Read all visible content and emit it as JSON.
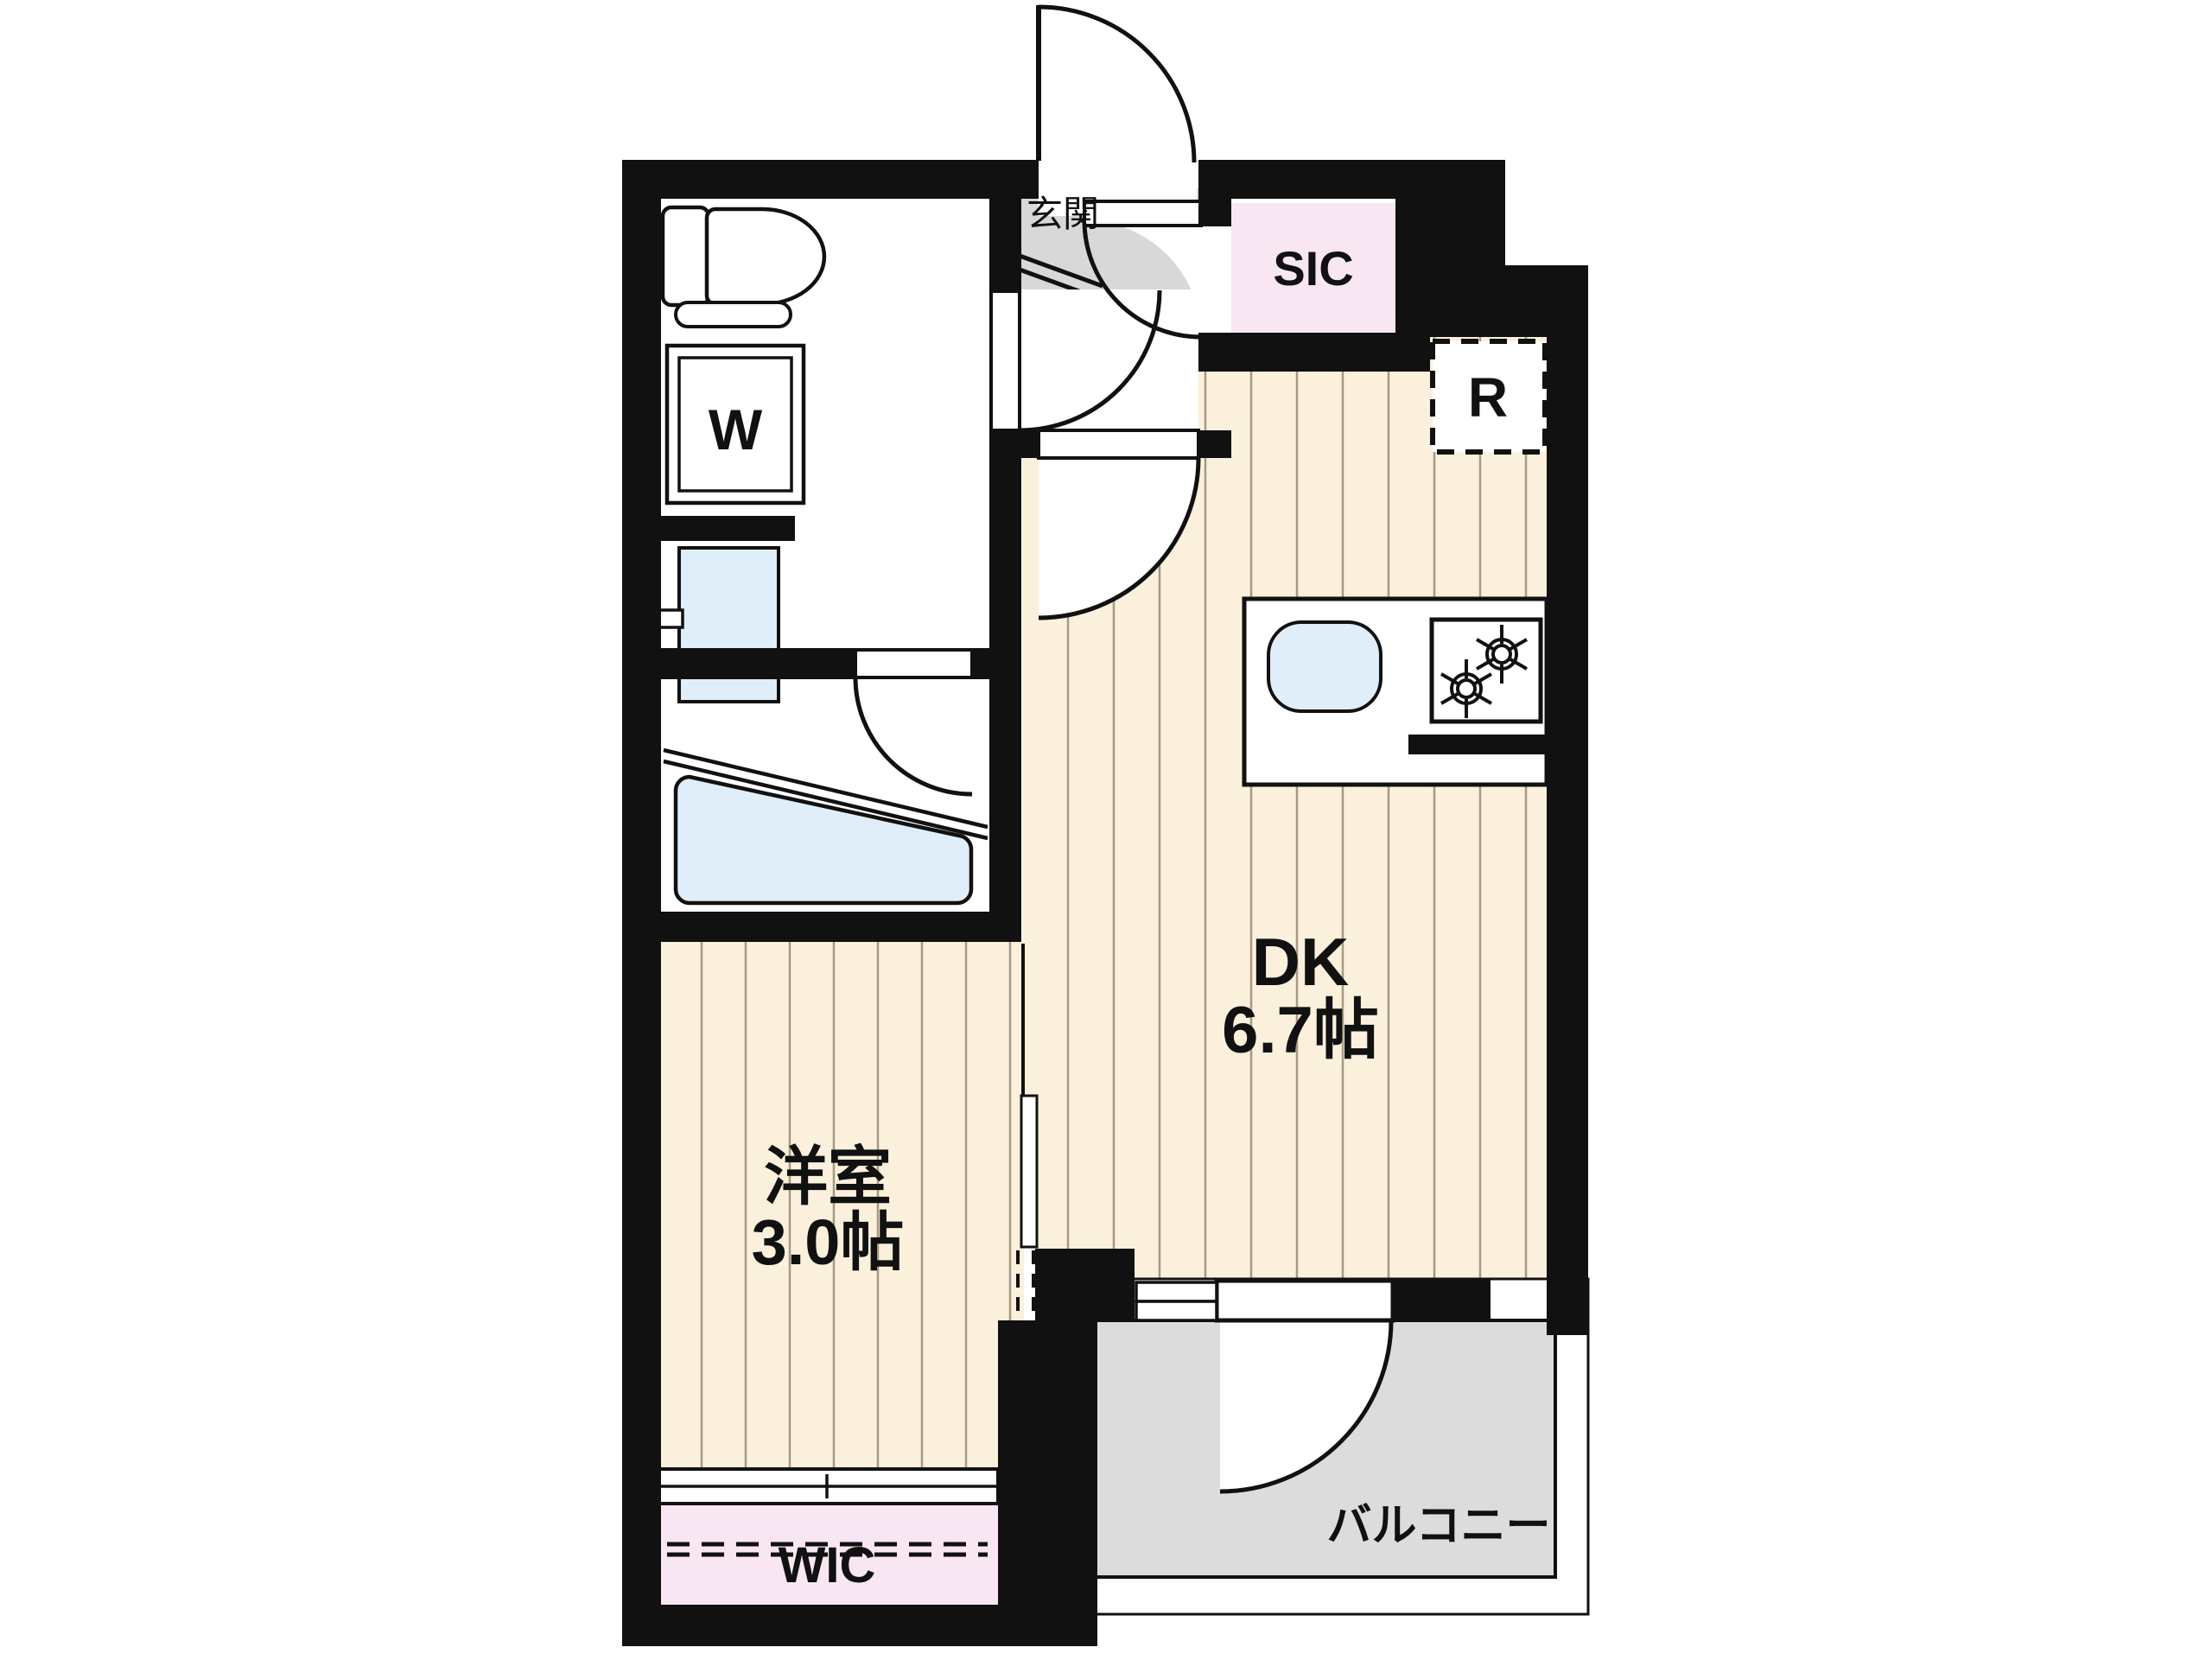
{
  "plan": {
    "type": "apartment-floor-plan",
    "labels": {
      "genkan": "玄関",
      "sic": "SIC",
      "refrigerator": "R",
      "washing_machine": "W",
      "dk_name": "DK",
      "dk_size": "6.7帖",
      "western_room_name": "洋室",
      "western_room_size": "3.0帖",
      "wic": "WIC",
      "balcony": "バルコニー"
    },
    "colors": {
      "wall": "#111111",
      "wood_floor": "#faf0dc",
      "floor_line": "#a69a85",
      "closet_pink": "#f8e6f2",
      "entrance_gray": "#d8d8d8",
      "balcony_gray": "#dcdcdc",
      "fixture_blue": "#dfeef8",
      "background": "#ffffff"
    },
    "fixtures": [
      "toilet",
      "washing-machine-space",
      "washbasin",
      "bathtub",
      "kitchen-sink",
      "gas-stove",
      "refrigerator-space",
      "hanger-pipe"
    ]
  }
}
